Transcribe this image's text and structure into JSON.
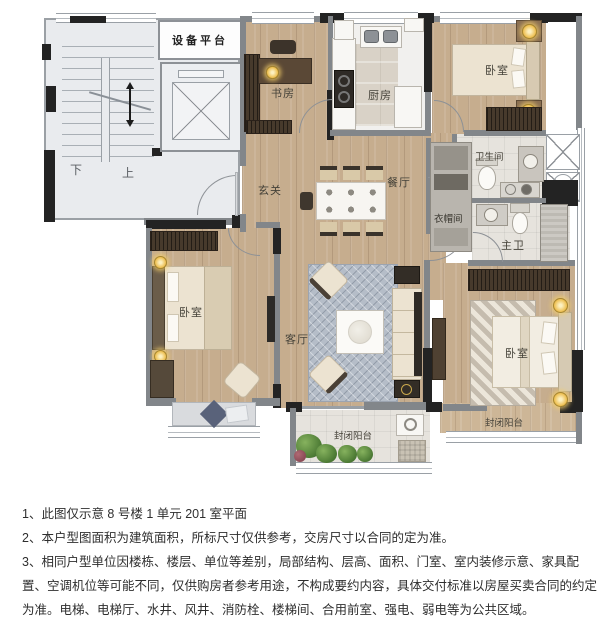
{
  "plan": {
    "labels": {
      "equipment_platform": "设备平台",
      "stairs_down": "下",
      "stairs_up": "上",
      "study": "书房",
      "kitchen": "厨房",
      "bedroom_top_right": "卧室",
      "foyer": "玄关",
      "dining": "餐厅",
      "bathroom": "卫生间",
      "cloakroom": "衣帽间",
      "master_bathroom": "主卫",
      "bedroom_left": "卧室",
      "living_room": "客厅",
      "master_bedroom": "卧室",
      "balcony_left": "封闭阳台",
      "balcony_right": "封闭阳台"
    },
    "colors": {
      "wood_floor": "#c6ad8e",
      "tile_floor": "#e6e3dd",
      "wall_dark": "#232323",
      "wall_gray": "#82868a",
      "stair_area": "#e9ebee",
      "lamp_glow": "#eec155",
      "plant_green": "#4d7b35",
      "living_rug": "#b5bdc8"
    }
  },
  "notes": {
    "line1": "1、此图仅示意 8 号楼 1 单元 201 室平面",
    "line2": "2、本户型图面积为建筑面积，所标尺寸仅供参考，交房尺寸以合同的定为准。",
    "line3": "3、相同户型单位因楼栋、楼层、单位等差别，局部结构、层高、面积、门室、室内装修示意、家具配置、空调机位等可能不同，仅供购房者参考用途，不构成要约内容，具体交付标准以房屋买卖合同的约定为准。电梯、电梯厅、水井、风井、消防栓、楼梯间、合用前室、强电、弱电等为公共区域。"
  }
}
